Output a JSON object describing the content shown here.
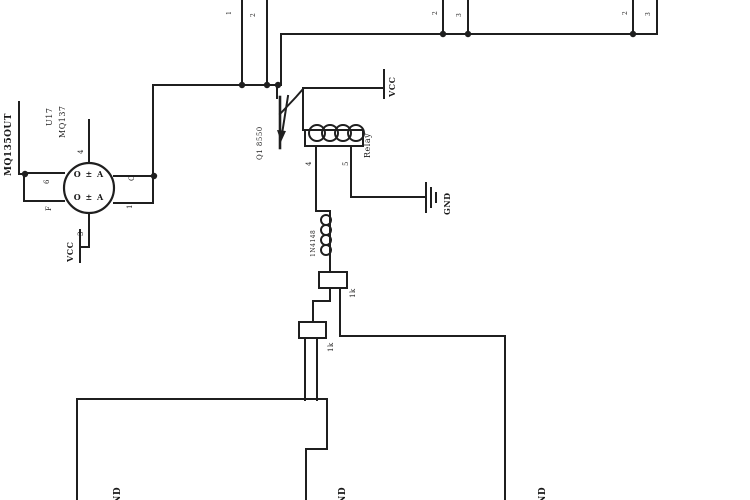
{
  "colors": {
    "ink": "#242424",
    "background": "#ffffff"
  },
  "schematic": {
    "sensor": {
      "net_label": "MQ135OUT",
      "refdes": "U17",
      "part": "MQ137",
      "inner_rows": [
        "O ± A",
        "O ± A"
      ],
      "pin_top": "4",
      "pin_left_top": "6",
      "pin_left_bottom": "F",
      "pin_right_top": "C",
      "pin_right_bottom": "1",
      "pin_bottom": "3",
      "supply_label": "VCC"
    },
    "transistor_label": "Q1 8550",
    "supply_label": "VCC",
    "relay": {
      "label": "Relay",
      "pin_left": "4",
      "pin_right": "5",
      "ground_label": "GND"
    },
    "diode_label": "1N4148",
    "resistor1_value": "1k",
    "resistor2_value": "1k",
    "ground_labels": [
      "GND",
      "GND",
      "GND"
    ],
    "header_pins": {
      "pair1": [
        "1",
        "2"
      ],
      "pair2": [
        "2",
        "3"
      ],
      "pair3": [
        "2",
        "3"
      ]
    }
  }
}
